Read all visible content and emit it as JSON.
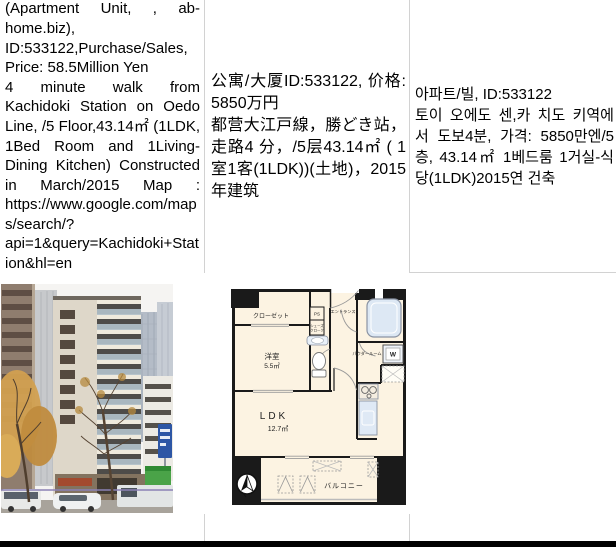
{
  "page": {
    "background": "#ffffff",
    "grid_border_color": "#d2d2d2",
    "bottom_bar_color": "#000000"
  },
  "listing": {
    "english": {
      "para1": "(Apartment Unit, , ab-home.biz), ID:533122,Purchase/Sales, Price: 58.5Million Yen",
      "para2": "4 minute walk from Kachidoki Station on Oedo Line, /5 Floor,43.14㎡ (1LDK, 1Bed Room and 1Living-Dining Kitchen) Constructed in March/2015 Map : https://www.google.com/maps/search/?api=1&query=Kachidoki+Station&hl=en"
    },
    "chinese": {
      "para1": "公寓/大厦ID:533122, 价格: 5850万円",
      "para2": "都营大江戸線，勝どき站，走路4 分，/5层43.14㎡ ( 1室1客(1LDK))(土地)，2015年建筑"
    },
    "korean": {
      "para1": "아파트/빌, ID:533122",
      "para2": "토이 오에도 센,카 치도 키역에서 도보4분, 가격: 5850만엔/5층, 43.14㎡ 1베드룸 1거실-식당(1LDK)2015연 건축"
    }
  },
  "floorplan": {
    "labels": {
      "closet": "クローゼット",
      "bedroom": "洋室",
      "bedroom_area": "5.5㎡",
      "ps": "PS",
      "entrance": "エントランス",
      "shoes_line1": "シューズ",
      "shoes_line2": "クローク",
      "powder_room": "パウダールーム",
      "washer": "W",
      "ldk": "LDK",
      "ldk_area": "12.7㎡",
      "balcony": "バルコニー"
    },
    "colors": {
      "floor": "#fcf3e2",
      "wall": "#1a1a1a",
      "fixture": "#dde8f4"
    }
  },
  "photo": {
    "subject": "building-exterior-street-view",
    "colors": {
      "sky": "#f5f4f2",
      "main_building": "#ded7c9",
      "foliage": "#d2a050",
      "sign_blue": "#2d56a5"
    }
  }
}
